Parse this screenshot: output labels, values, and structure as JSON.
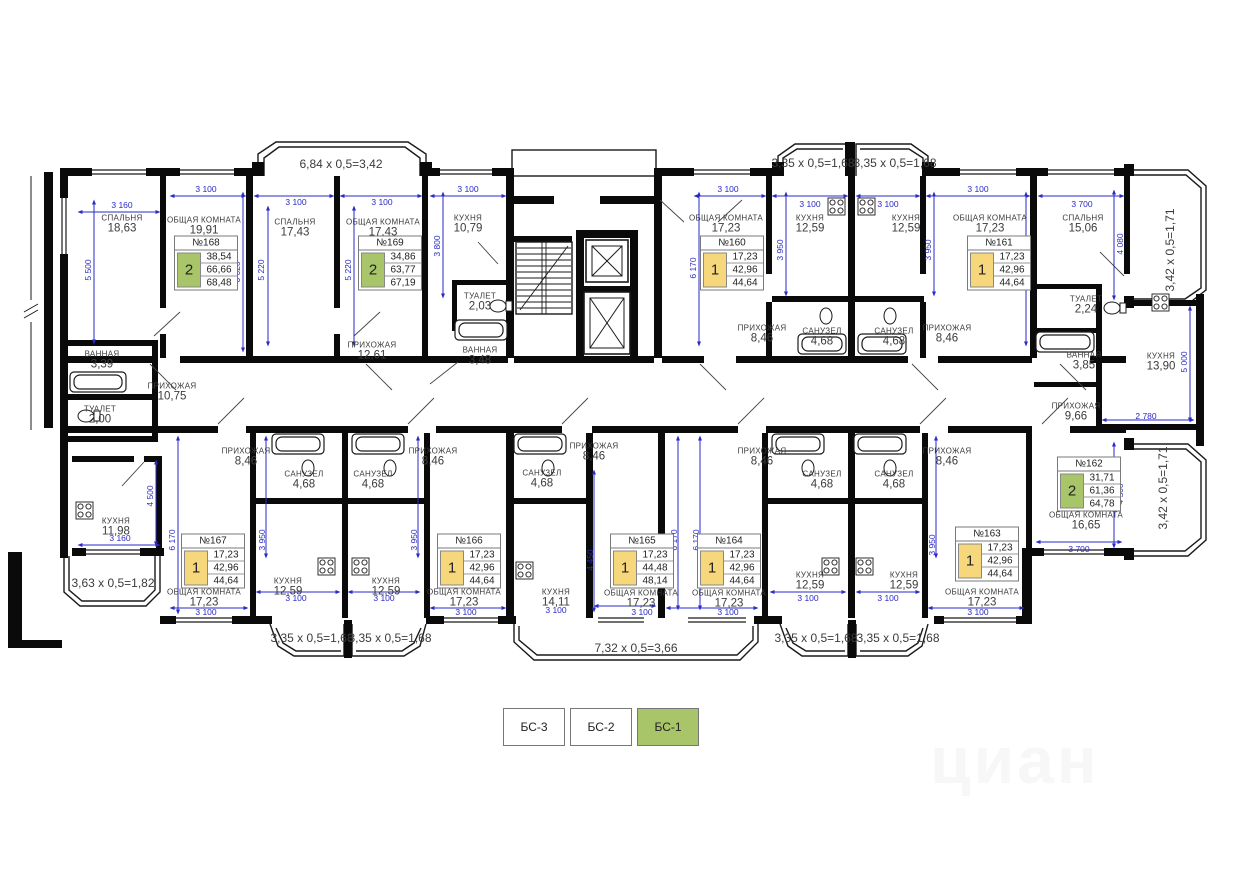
{
  "colors": {
    "wall": "#0a0a0a",
    "dim_blue": "#2a2ac8",
    "label_gray": "#3b3b3b",
    "card_green": "#a9c56a",
    "card_yellow": "#f6d77b",
    "legend_active": "#a9c56a"
  },
  "watermark": "циан",
  "legend": {
    "items": [
      {
        "label": "БС-3",
        "active": false
      },
      {
        "label": "БС-2",
        "active": false
      },
      {
        "label": "БС-1",
        "active": true
      }
    ]
  },
  "rooms": [
    {
      "name": "СПАЛЬНЯ",
      "area": "18,63",
      "x": 122,
      "y": 224
    },
    {
      "name": "ОБЩАЯ КОМНАТА",
      "area": "19,91",
      "x": 204,
      "y": 226
    },
    {
      "name": "СПАЛЬНЯ",
      "area": "17,43",
      "x": 295,
      "y": 228
    },
    {
      "name": "ОБЩАЯ КОМНАТА",
      "area": "17,43",
      "x": 383,
      "y": 228
    },
    {
      "name": "КУХНЯ",
      "area": "10,79",
      "x": 468,
      "y": 224
    },
    {
      "name": "ТУАЛЕТ",
      "area": "2,03",
      "x": 480,
      "y": 302
    },
    {
      "name": "ВАННАЯ",
      "area": "3,48",
      "x": 480,
      "y": 356
    },
    {
      "name": "ПРИХОЖАЯ",
      "area": "12,61",
      "x": 372,
      "y": 351
    },
    {
      "name": "ВАННАЯ",
      "area": "3,39",
      "x": 102,
      "y": 360
    },
    {
      "name": "ПРИХОЖАЯ",
      "area": "10,75",
      "x": 172,
      "y": 392
    },
    {
      "name": "ТУАЛЕТ",
      "area": "2,00",
      "x": 100,
      "y": 415
    },
    {
      "name": "КУХНЯ",
      "area": "11,98",
      "x": 116,
      "y": 527
    },
    {
      "name": "ОБЩАЯ КОМНАТА",
      "area": "17,23",
      "x": 726,
      "y": 224
    },
    {
      "name": "КУХНЯ",
      "area": "12,59",
      "x": 810,
      "y": 224
    },
    {
      "name": "КУХНЯ",
      "area": "12,59",
      "x": 906,
      "y": 224
    },
    {
      "name": "ОБЩАЯ КОМНАТА",
      "area": "17,23",
      "x": 990,
      "y": 224
    },
    {
      "name": "ПРИХОЖАЯ",
      "area": "8,46",
      "x": 762,
      "y": 334
    },
    {
      "name": "САНУЗЕЛ",
      "area": "4,68",
      "x": 822,
      "y": 337
    },
    {
      "name": "САНУЗЕЛ",
      "area": "4,68",
      "x": 894,
      "y": 337
    },
    {
      "name": "ПРИХОЖАЯ",
      "area": "8,46",
      "x": 947,
      "y": 334
    },
    {
      "name": "СПАЛЬНЯ",
      "area": "15,06",
      "x": 1083,
      "y": 224
    },
    {
      "name": "ТУАЛЕТ",
      "area": "2,24",
      "x": 1086,
      "y": 305
    },
    {
      "name": "ВАННАЯ",
      "area": "3,85",
      "x": 1084,
      "y": 361
    },
    {
      "name": "КУХНЯ",
      "area": "13,90",
      "x": 1161,
      "y": 362
    },
    {
      "name": "ПРИХОЖАЯ",
      "area": "9,66",
      "x": 1076,
      "y": 412
    },
    {
      "name": "ОБЩАЯ КОМНАТА",
      "area": "16,65",
      "x": 1086,
      "y": 521
    },
    {
      "name": "ПРИХОЖАЯ",
      "area": "8,46",
      "x": 246,
      "y": 457
    },
    {
      "name": "САНУЗЕЛ",
      "area": "4,68",
      "x": 304,
      "y": 480
    },
    {
      "name": "САНУЗЕЛ",
      "area": "4,68",
      "x": 373,
      "y": 480
    },
    {
      "name": "ПРИХОЖАЯ",
      "area": "8,46",
      "x": 433,
      "y": 457
    },
    {
      "name": "САНУЗЕЛ",
      "area": "4,68",
      "x": 542,
      "y": 479
    },
    {
      "name": "ПРИХОЖАЯ",
      "area": "8,46",
      "x": 594,
      "y": 452
    },
    {
      "name": "ПРИХОЖАЯ",
      "area": "8,46",
      "x": 762,
      "y": 457
    },
    {
      "name": "САНУЗЕЛ",
      "area": "4,68",
      "x": 822,
      "y": 480
    },
    {
      "name": "САНУЗЕЛ",
      "area": "4,68",
      "x": 894,
      "y": 480
    },
    {
      "name": "ПРИХОЖАЯ",
      "area": "8,46",
      "x": 947,
      "y": 457
    },
    {
      "name": "ОБЩАЯ КОМНАТА",
      "area": "17,23",
      "x": 204,
      "y": 598
    },
    {
      "name": "КУХНЯ",
      "area": "12,59",
      "x": 288,
      "y": 587
    },
    {
      "name": "КУХНЯ",
      "area": "12,59",
      "x": 386,
      "y": 587
    },
    {
      "name": "ОБЩАЯ КОМНАТА",
      "area": "17,23",
      "x": 464,
      "y": 598
    },
    {
      "name": "КУХНЯ",
      "area": "14,11",
      "x": 556,
      "y": 598
    },
    {
      "name": "ОБЩАЯ КОМНАТА",
      "area": "17,23",
      "x": 641,
      "y": 599
    },
    {
      "name": "ОБЩАЯ КОМНАТА",
      "area": "17,23",
      "x": 729,
      "y": 599
    },
    {
      "name": "КУХНЯ",
      "area": "12,59",
      "x": 810,
      "y": 581
    },
    {
      "name": "КУХНЯ",
      "area": "12,59",
      "x": 904,
      "y": 581
    },
    {
      "name": "ОБЩАЯ КОМНАТА",
      "area": "17,23",
      "x": 982,
      "y": 598
    }
  ],
  "cards": [
    {
      "number": "№168",
      "rooms": "2",
      "color": "green",
      "values": [
        "38,54",
        "66,66",
        "68,48"
      ],
      "x": 206,
      "y": 263
    },
    {
      "number": "№169",
      "rooms": "2",
      "color": "green",
      "values": [
        "34,86",
        "63,77",
        "67,19"
      ],
      "x": 390,
      "y": 263
    },
    {
      "number": "№160",
      "rooms": "1",
      "color": "yellow",
      "values": [
        "17,23",
        "42,96",
        "44,64"
      ],
      "x": 732,
      "y": 263
    },
    {
      "number": "№161",
      "rooms": "1",
      "color": "yellow",
      "values": [
        "17,23",
        "42,96",
        "44,64"
      ],
      "x": 999,
      "y": 263
    },
    {
      "number": "№162",
      "rooms": "2",
      "color": "green",
      "values": [
        "31,71",
        "61,36",
        "64,78"
      ],
      "x": 1089,
      "y": 484
    },
    {
      "number": "№167",
      "rooms": "1",
      "color": "yellow",
      "values": [
        "17,23",
        "42,96",
        "44,64"
      ],
      "x": 213,
      "y": 561
    },
    {
      "number": "№166",
      "rooms": "1",
      "color": "yellow",
      "values": [
        "17,23",
        "42,96",
        "44,64"
      ],
      "x": 469,
      "y": 561
    },
    {
      "number": "№165",
      "rooms": "1",
      "color": "yellow",
      "values": [
        "17,23",
        "44,48",
        "48,14"
      ],
      "x": 642,
      "y": 561
    },
    {
      "number": "№164",
      "rooms": "1",
      "color": "yellow",
      "values": [
        "17,23",
        "42,96",
        "44,64"
      ],
      "x": 729,
      "y": 561
    },
    {
      "number": "№163",
      "rooms": "1",
      "color": "yellow",
      "values": [
        "17,23",
        "42,96",
        "44,64"
      ],
      "x": 987,
      "y": 554
    }
  ],
  "dims": [
    {
      "t": "3 160",
      "x": 122,
      "y": 205
    },
    {
      "t": "3 100",
      "x": 206,
      "y": 189
    },
    {
      "t": "3 100",
      "x": 296,
      "y": 202
    },
    {
      "t": "3 100",
      "x": 382,
      "y": 202
    },
    {
      "t": "3 100",
      "x": 468,
      "y": 189
    },
    {
      "t": "3 100",
      "x": 728,
      "y": 189
    },
    {
      "t": "3 100",
      "x": 810,
      "y": 204
    },
    {
      "t": "3 100",
      "x": 888,
      "y": 204
    },
    {
      "t": "3 100",
      "x": 978,
      "y": 189
    },
    {
      "t": "3 700",
      "x": 1082,
      "y": 204
    },
    {
      "t": "6,84 х 0,5=3,42",
      "x": 341,
      "y": 164,
      "bay": 1
    },
    {
      "t": "3,35 х 0,5=1,68",
      "x": 813,
      "y": 163,
      "bay": 1
    },
    {
      "t": "3,35 х 0,5=1,68",
      "x": 895,
      "y": 163,
      "bay": 1
    },
    {
      "t": "5 500",
      "x": 88,
      "y": 270,
      "v": 1
    },
    {
      "t": "6 020",
      "x": 237,
      "y": 272,
      "v": 1
    },
    {
      "t": "5 220",
      "x": 261,
      "y": 270,
      "v": 1
    },
    {
      "t": "5 220",
      "x": 348,
      "y": 270,
      "v": 1
    },
    {
      "t": "3 800",
      "x": 437,
      "y": 246,
      "v": 1
    },
    {
      "t": "6 170",
      "x": 693,
      "y": 268,
      "v": 1
    },
    {
      "t": "3 950",
      "x": 780,
      "y": 250,
      "v": 1
    },
    {
      "t": "3 950",
      "x": 928,
      "y": 250,
      "v": 1
    },
    {
      "t": "6 170",
      "x": 1020,
      "y": 268,
      "v": 1
    },
    {
      "t": "4 080",
      "x": 1120,
      "y": 244,
      "v": 1
    },
    {
      "t": "3,42 х 0,5=1,71",
      "x": 1170,
      "y": 250,
      "v": 1,
      "bay": 1
    },
    {
      "t": "5 000",
      "x": 1184,
      "y": 362,
      "v": 1
    },
    {
      "t": "2 780",
      "x": 1146,
      "y": 416
    },
    {
      "t": "4 500",
      "x": 1120,
      "y": 494,
      "v": 1
    },
    {
      "t": "3,42 х 0,5=1,71",
      "x": 1163,
      "y": 488,
      "v": 1,
      "bay": 1
    },
    {
      "t": "3 700",
      "x": 1079,
      "y": 549
    },
    {
      "t": "4 500",
      "x": 150,
      "y": 496,
      "v": 1
    },
    {
      "t": "3 160",
      "x": 120,
      "y": 538
    },
    {
      "t": "3,63 х 0,5=1,82",
      "x": 113,
      "y": 583,
      "bay": 1
    },
    {
      "t": "6 170",
      "x": 172,
      "y": 540,
      "v": 1
    },
    {
      "t": "3 950",
      "x": 262,
      "y": 540,
      "v": 1
    },
    {
      "t": "3 950",
      "x": 414,
      "y": 540,
      "v": 1
    },
    {
      "t": "6 170",
      "x": 674,
      "y": 540,
      "v": 1
    },
    {
      "t": "6 170",
      "x": 696,
      "y": 540,
      "v": 1
    },
    {
      "t": "4 450",
      "x": 590,
      "y": 560,
      "v": 1
    },
    {
      "t": "3 950",
      "x": 932,
      "y": 545,
      "v": 1
    },
    {
      "t": "3 100",
      "x": 206,
      "y": 612
    },
    {
      "t": "3 100",
      "x": 296,
      "y": 598
    },
    {
      "t": "3 100",
      "x": 384,
      "y": 598
    },
    {
      "t": "3 100",
      "x": 466,
      "y": 612
    },
    {
      "t": "3 100",
      "x": 556,
      "y": 610
    },
    {
      "t": "3 100",
      "x": 642,
      "y": 612
    },
    {
      "t": "3 100",
      "x": 728,
      "y": 612
    },
    {
      "t": "3 100",
      "x": 808,
      "y": 598
    },
    {
      "t": "3 100",
      "x": 888,
      "y": 598
    },
    {
      "t": "3 100",
      "x": 978,
      "y": 612
    },
    {
      "t": "3,35 х 0,5=1,68",
      "x": 312,
      "y": 638,
      "bay": 1
    },
    {
      "t": "3,35 х 0,5=1,68",
      "x": 390,
      "y": 638,
      "bay": 1
    },
    {
      "t": "7,32 х 0,5=3,66",
      "x": 636,
      "y": 648,
      "bay": 1
    },
    {
      "t": "3,35 х 0,5=1,68",
      "x": 816,
      "y": 638,
      "bay": 1
    },
    {
      "t": "3,35 х 0,5=1,68",
      "x": 898,
      "y": 638,
      "bay": 1
    }
  ]
}
